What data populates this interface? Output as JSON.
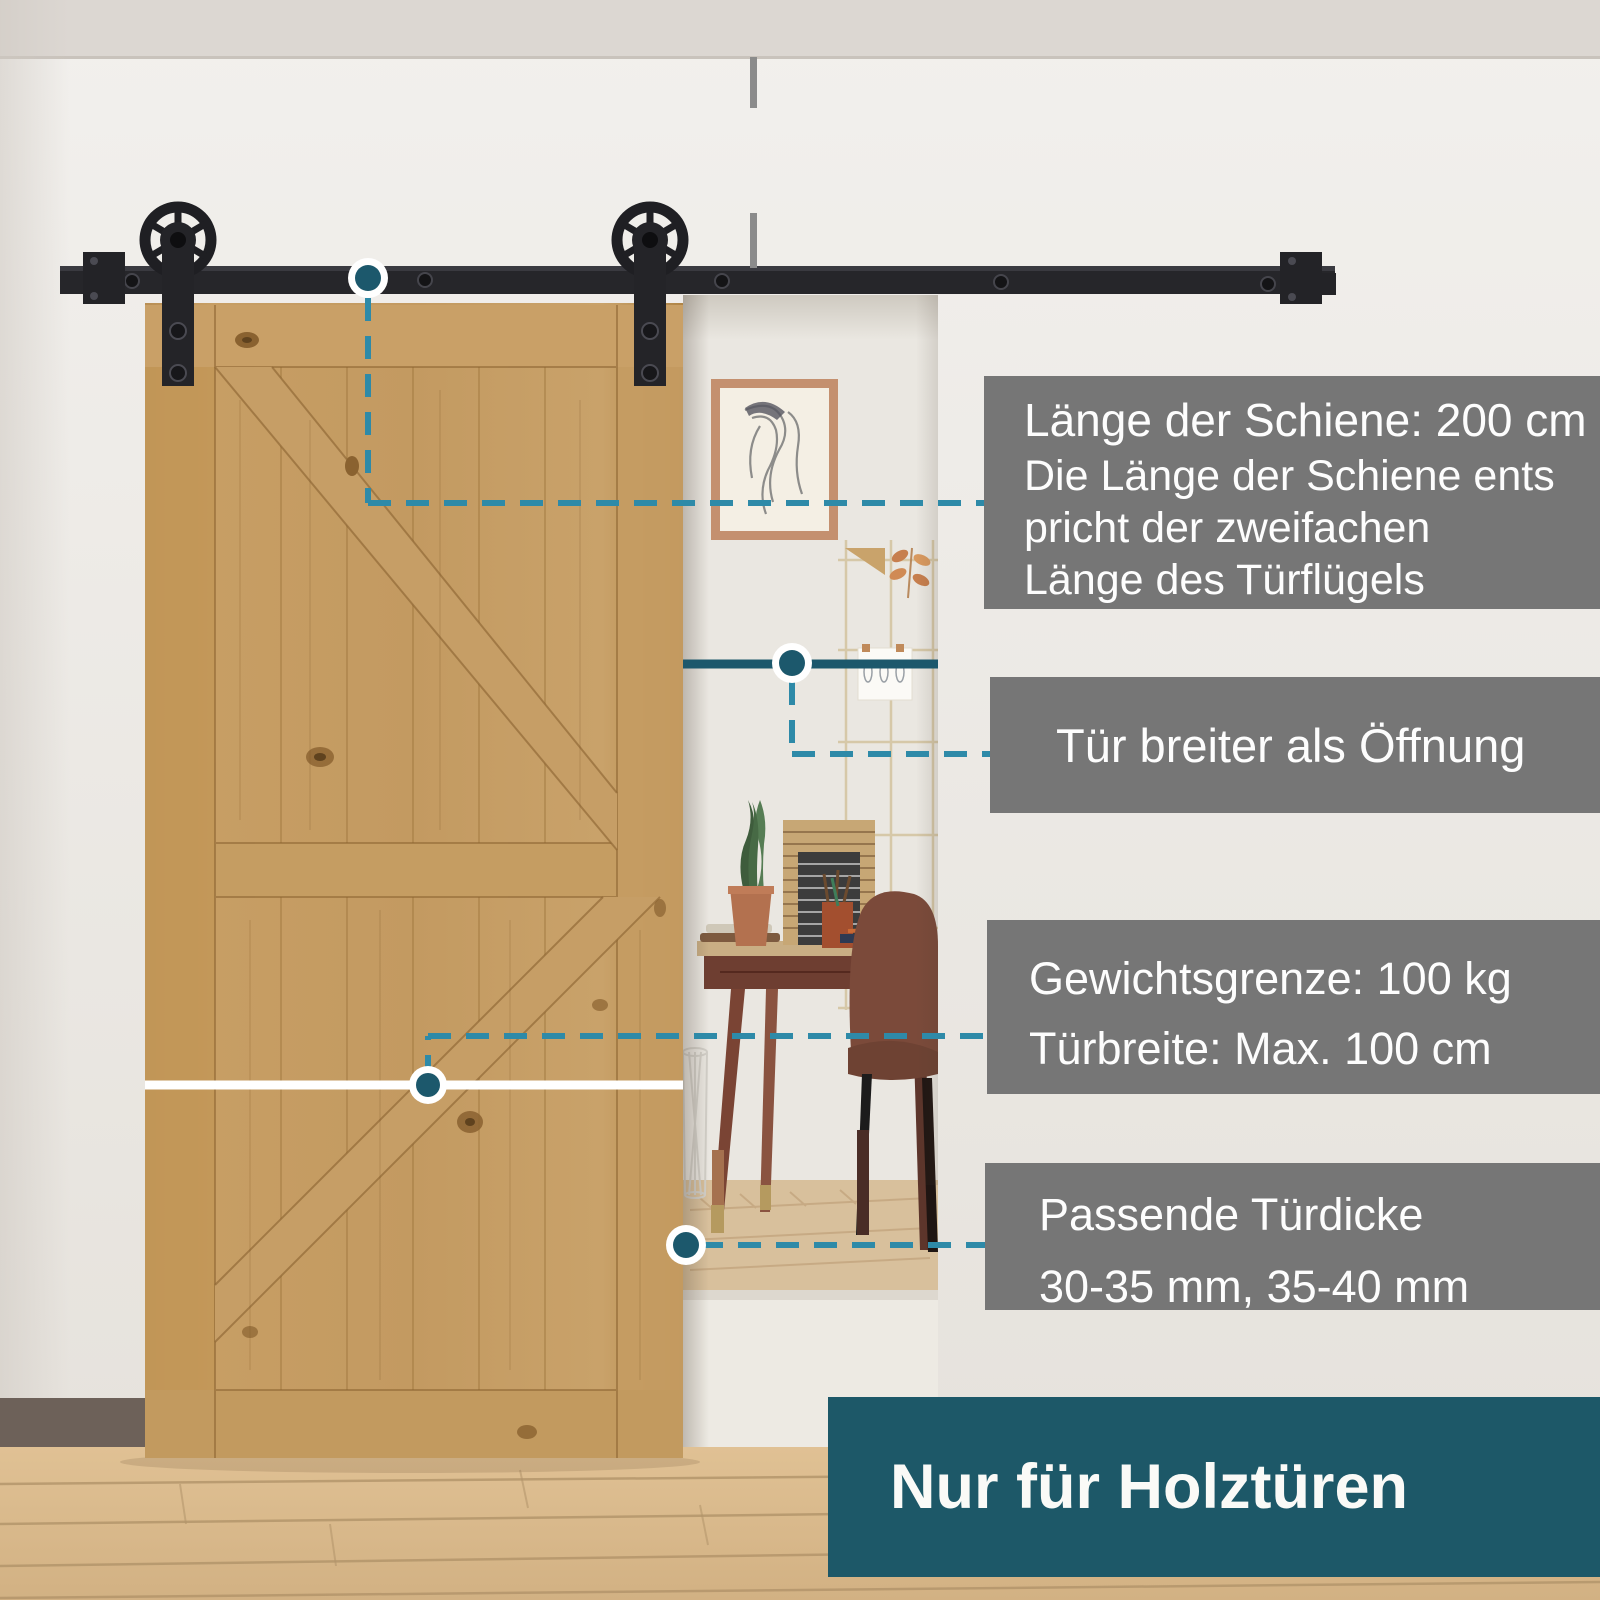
{
  "product_scene": {
    "type": "sliding-barn-door-hardware-infographic",
    "language": "de"
  },
  "callouts": {
    "rail_length": {
      "title": "Länge der Schiene: 200 cm",
      "body_lines": [
        "Die Länge der Schiene ents",
        "pricht der zweifachen",
        "Länge des Türflügels"
      ]
    },
    "door_wider": {
      "label": "Tür breiter als Öffnung"
    },
    "weight_limit": {
      "line1": "Gewichtsgrenze: 100 kg",
      "line2": "Türbreite: Max. 100 cm"
    },
    "door_thickness": {
      "line1": "Passende Türdicke",
      "line2": "30-35 mm, 35-40 mm"
    },
    "footer": {
      "label": "Nur für Holztüren"
    }
  },
  "colors": {
    "callout_box_gray": "#767676",
    "footer_teal": "#1d5868",
    "accent_dash_teal": "#2e8aa8",
    "accent_dot_teal": "#1c586c",
    "hardware_black": "#2a2a2e",
    "door_wood": "#c39a61",
    "floor_wood": "#d9ba8c",
    "wall": "#eceae6",
    "white_marker_line": "#ffffff"
  }
}
